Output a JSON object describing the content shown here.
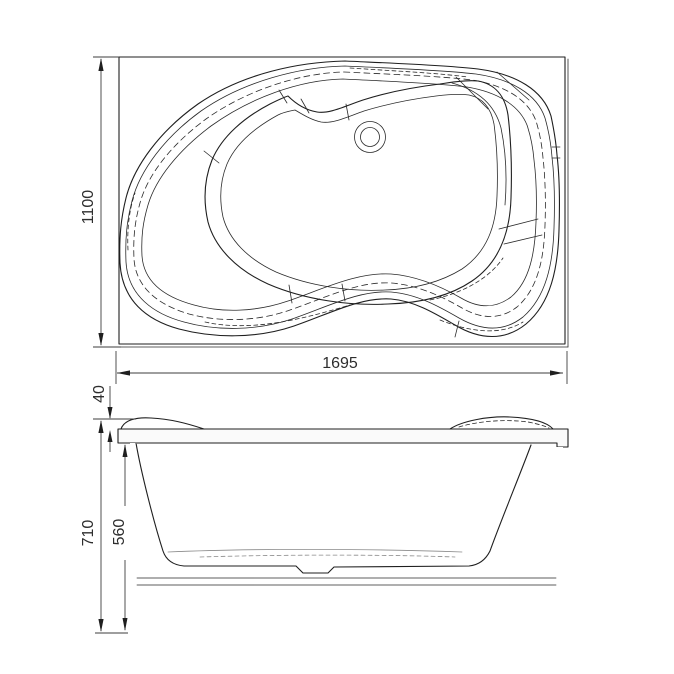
{
  "palette": {
    "background": "#ffffff",
    "line": "#1f1f1f",
    "dimension_line": "#3d3d3d",
    "dimension_text": "#2e2e2e",
    "light_fill": "#fafafa"
  },
  "views": {
    "plan": {
      "width_label": "1695",
      "height_label": "1100"
    },
    "front": {
      "rim_rise_label": "40",
      "overall_height_label": "710",
      "shell_height_label": "560"
    }
  }
}
